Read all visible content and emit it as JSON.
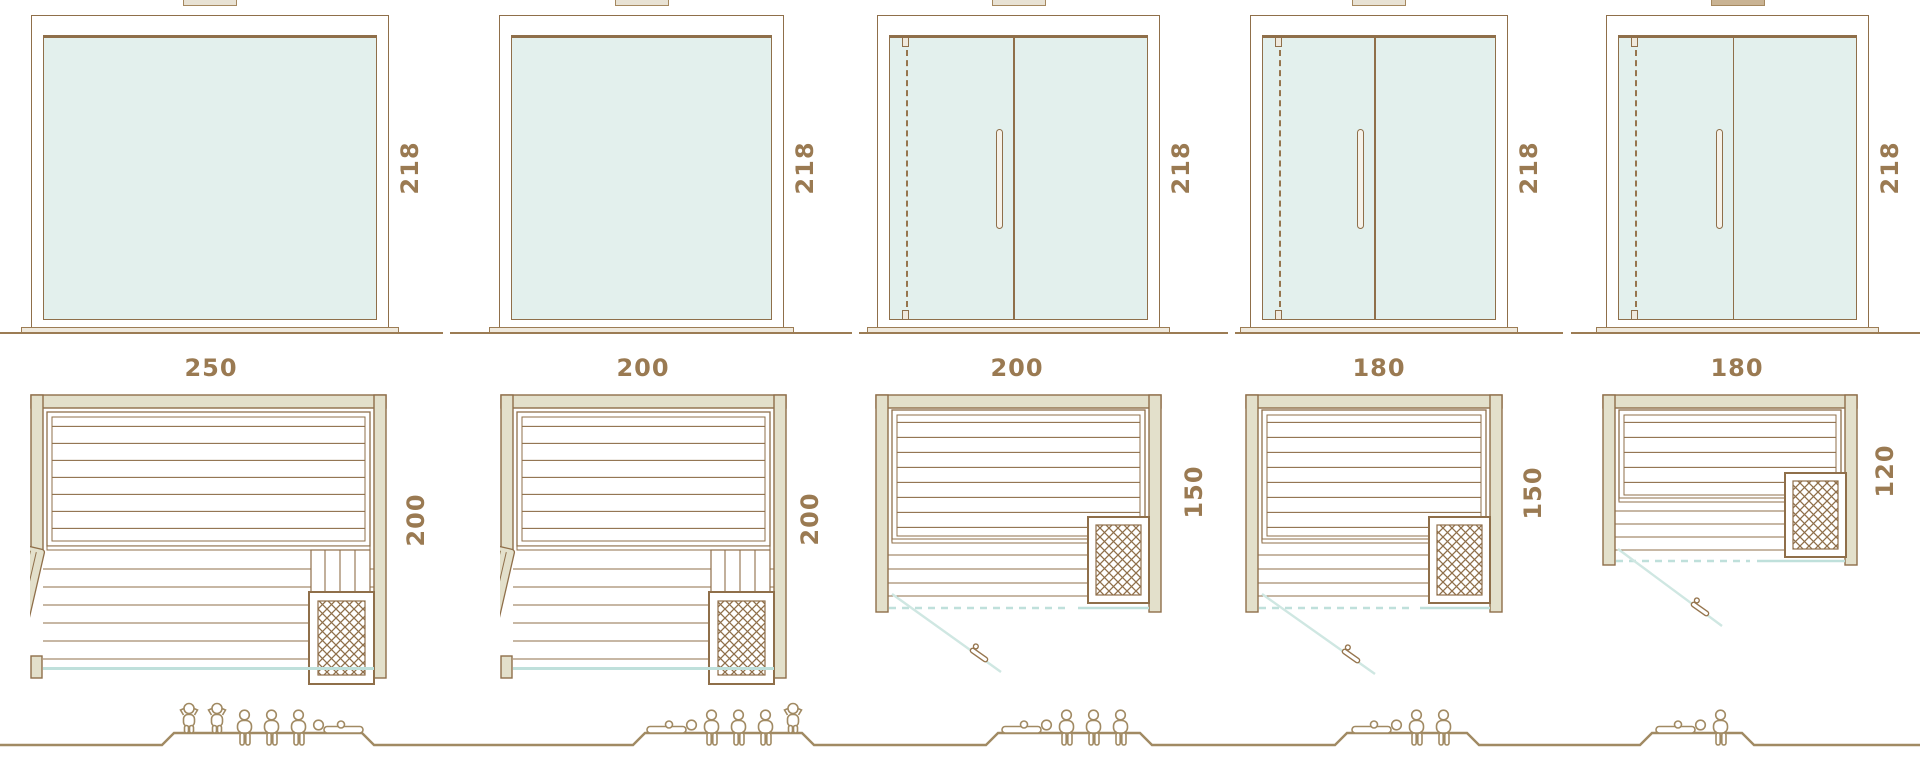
{
  "diagram_title": "sauna-size-comparison",
  "palette": {
    "line_brown": "#8f6f4a",
    "label_brown": "#9a7a52",
    "wall_fill": "#e3e0cb",
    "glass_fill": "#e3f0ed",
    "glass_line_teal": "#bfe0db",
    "door_swing_teal": "#cfe7e2",
    "people_brown": "#a18a63"
  },
  "saunas": [
    {
      "name": "sauna-250x200",
      "front_height": "218",
      "width": "250",
      "depth": "200",
      "front_type": "fixed-glass",
      "plan_door": "open-leaf-left",
      "figures": [
        "standing",
        "standing",
        "sitting",
        "sitting",
        "sitting",
        "lying-left"
      ]
    },
    {
      "name": "sauna-200x200",
      "front_height": "218",
      "width": "200",
      "depth": "200",
      "front_type": "fixed-glass",
      "plan_door": "open-leaf-left",
      "figures": [
        "lying-right",
        "sitting",
        "sitting",
        "sitting",
        "standing"
      ]
    },
    {
      "name": "sauna-200x150",
      "front_height": "218",
      "width": "200",
      "depth": "150",
      "front_type": "glass-door-front",
      "plan_door": "swing-out-left",
      "figures": [
        "lying-right",
        "sitting",
        "sitting",
        "sitting"
      ]
    },
    {
      "name": "sauna-180x150",
      "front_height": "218",
      "width": "180",
      "depth": "150",
      "front_type": "glass-door-front",
      "plan_door": "swing-out-left",
      "figures": [
        "lying-right",
        "sitting",
        "sitting"
      ]
    },
    {
      "name": "sauna-180x120",
      "front_height": "218",
      "width": "180",
      "depth": "120",
      "front_type": "glass-door-front",
      "plan_door": "swing-out-left",
      "figures": [
        "lying-right",
        "sitting"
      ]
    }
  ]
}
